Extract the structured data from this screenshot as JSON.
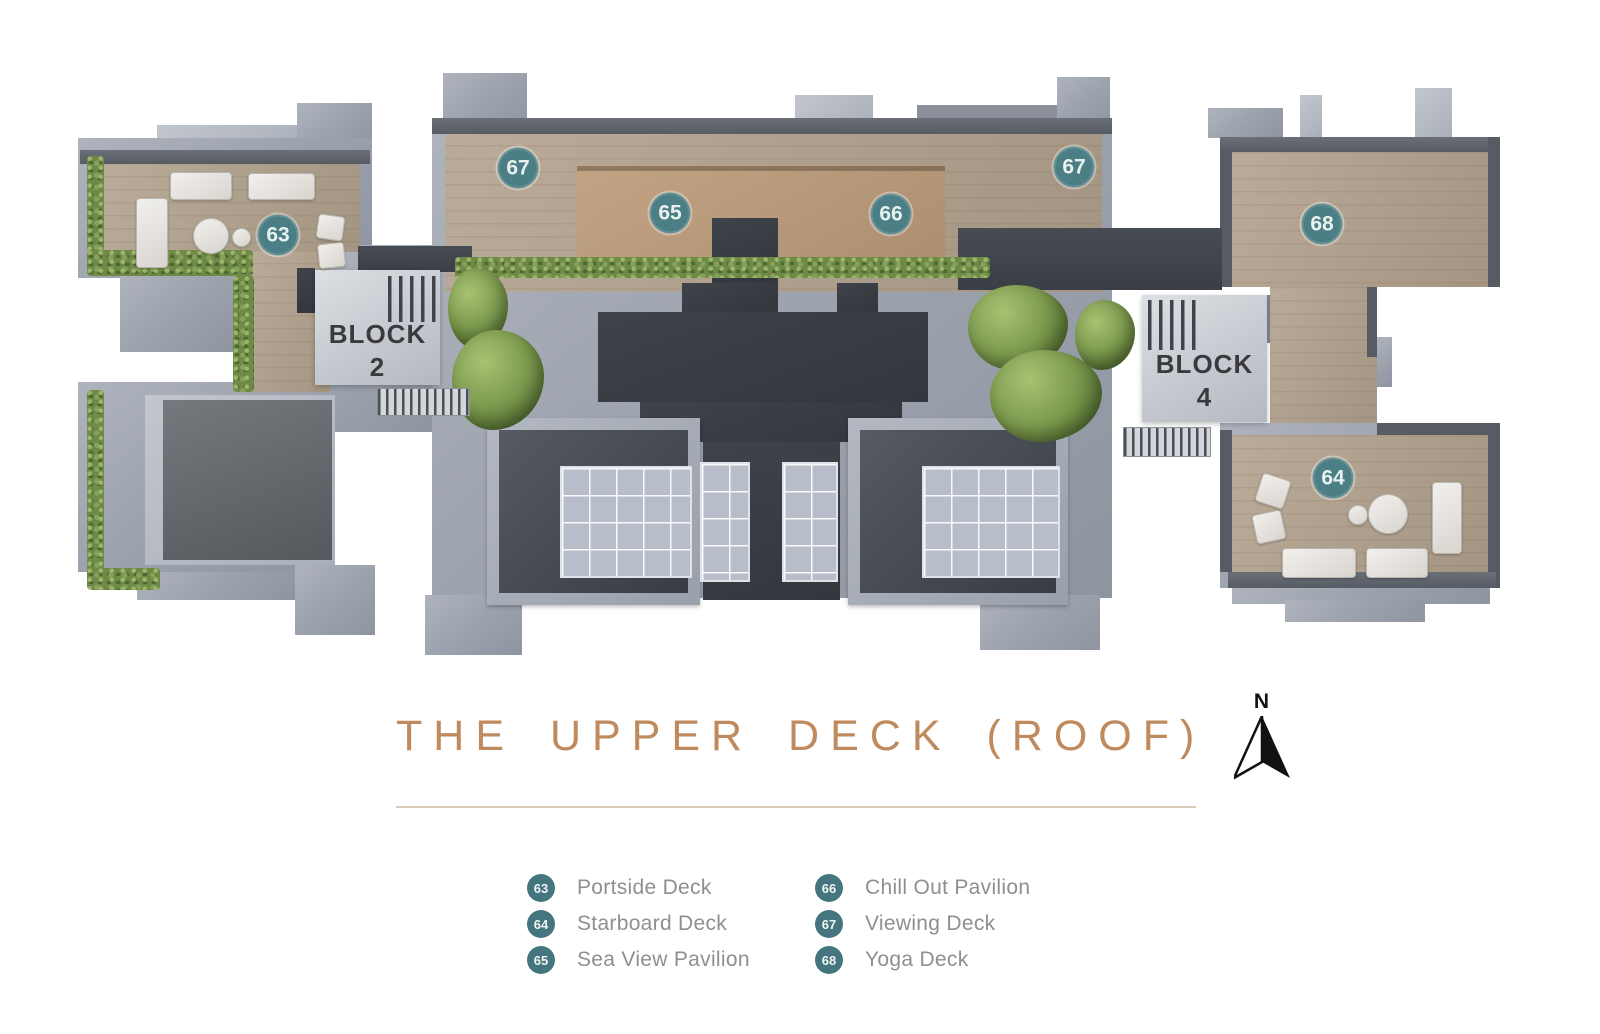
{
  "plan": {
    "markers": [
      {
        "num": "63"
      },
      {
        "num": "64"
      },
      {
        "num": "65"
      },
      {
        "num": "66"
      },
      {
        "num": "67"
      },
      {
        "num": "67"
      },
      {
        "num": "68"
      }
    ],
    "blocks": [
      {
        "line1": "BLOCK",
        "line2": "2"
      },
      {
        "line1": "BLOCK",
        "line2": "4"
      }
    ]
  },
  "title": {
    "text": "THE UPPER DECK (ROOF)"
  },
  "compass": {
    "label": "N"
  },
  "legend": {
    "columns": [
      {
        "items": [
          {
            "num": "63",
            "label": "Portside Deck"
          },
          {
            "num": "64",
            "label": "Starboard Deck"
          },
          {
            "num": "65",
            "label": "Sea View Pavilion"
          }
        ]
      },
      {
        "items": [
          {
            "num": "66",
            "label": "Chill Out Pavilion"
          },
          {
            "num": "67",
            "label": "Viewing Deck"
          },
          {
            "num": "68",
            "label": "Yoga Deck"
          }
        ]
      }
    ]
  },
  "colors": {
    "badge": "#4b7e85",
    "title": "#bf8a5e",
    "legend_text": "#8f8f8f"
  }
}
